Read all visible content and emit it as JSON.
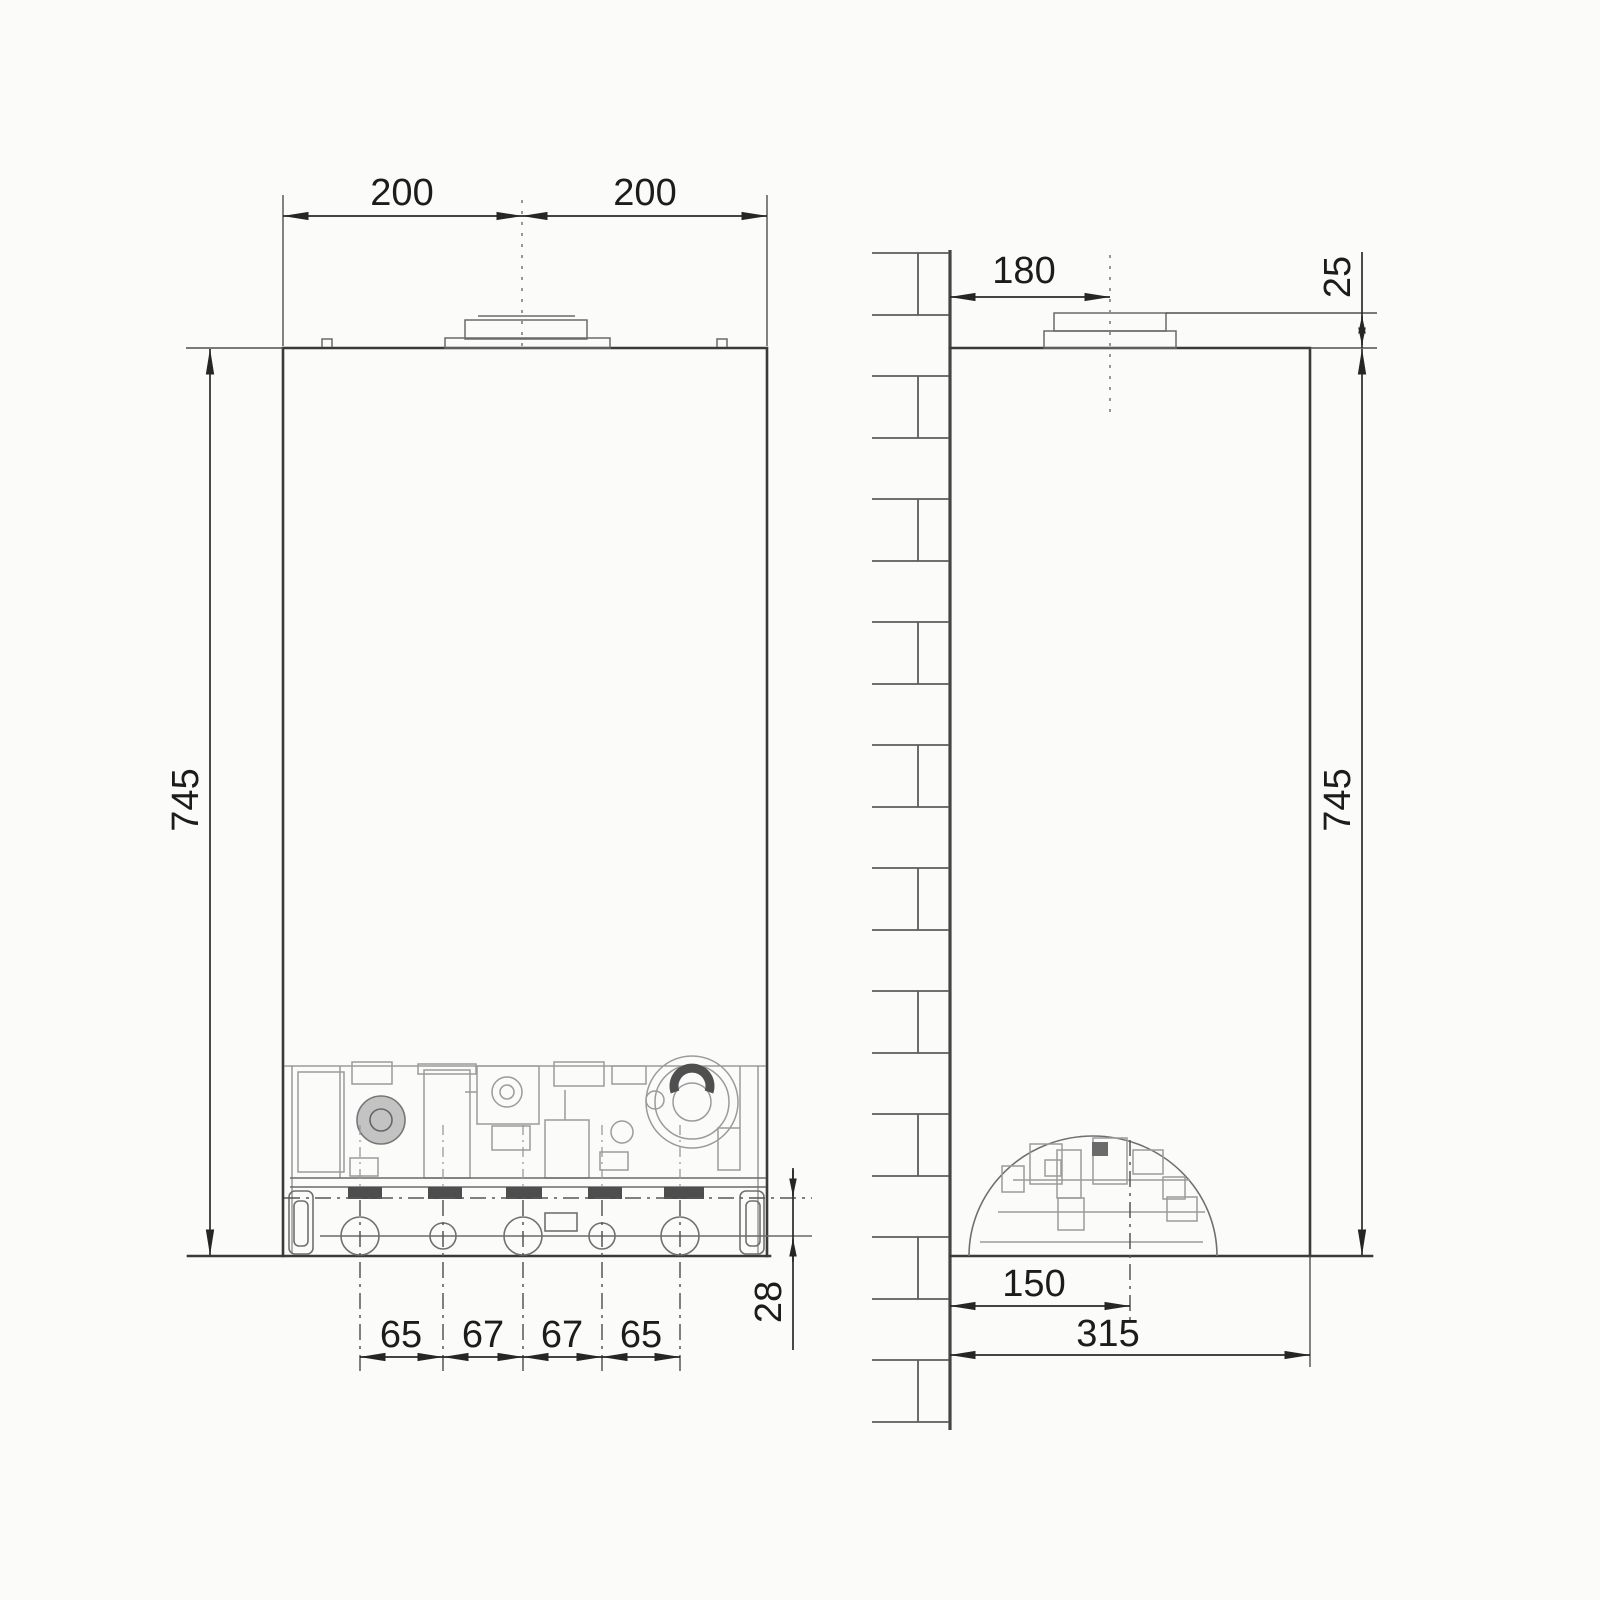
{
  "drawing": {
    "front": {
      "flue_offset_left": "200",
      "flue_offset_right": "200",
      "height": "745",
      "pipe_spacing": [
        "65",
        "67",
        "67",
        "65"
      ],
      "pipe_drop": "28"
    },
    "side": {
      "wall_to_flue": "180",
      "collar_height": "25",
      "height": "745",
      "wall_to_trap": "150",
      "depth": "315"
    },
    "colors": {
      "ink": "#3a3a3a",
      "dimension_ink": "#2a2a2a",
      "machinery": "#9b9b9b",
      "background": "#fbfbf9"
    }
  }
}
